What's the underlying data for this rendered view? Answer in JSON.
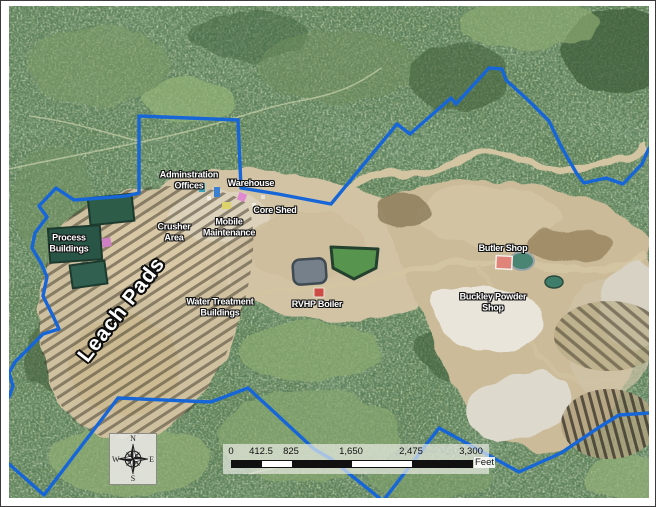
{
  "map": {
    "labels": {
      "admin_offices": {
        "line1": "Adminstration",
        "line2": "Offices"
      },
      "warehouse": {
        "text": "Warehouse"
      },
      "core_shed": {
        "text": "Core Shed"
      },
      "mobile_maintenance": {
        "line1": "Mobile",
        "line2": "Maintenance"
      },
      "crusher_area": {
        "line1": "Crusher",
        "line2": "Area"
      },
      "process_buildings": {
        "line1": "Process",
        "line2": "Buildings"
      },
      "leach_pads": {
        "text": "Leach Pads"
      },
      "water_treatment": {
        "line1": "Water Treatment",
        "line2": "Buildings"
      },
      "rvhp_boiler": {
        "text": "RVHP Boiler"
      },
      "butler_shop": {
        "text": "Butler Shop"
      },
      "buckley_powder_shop": {
        "line1": "Buckley Powder",
        "line2": "Shop"
      }
    },
    "compass": {
      "north": "N",
      "east": "E",
      "south": "S",
      "west": "W"
    },
    "scale_bar": {
      "ticks": [
        "0",
        "412.5",
        "825",
        "1,650",
        "2,475",
        "3,300"
      ],
      "unit": "Feet"
    },
    "colors": {
      "boundary_line": "#1766d8",
      "forest_green": "#66855a",
      "mine_tan": "#cfc0a0"
    }
  }
}
